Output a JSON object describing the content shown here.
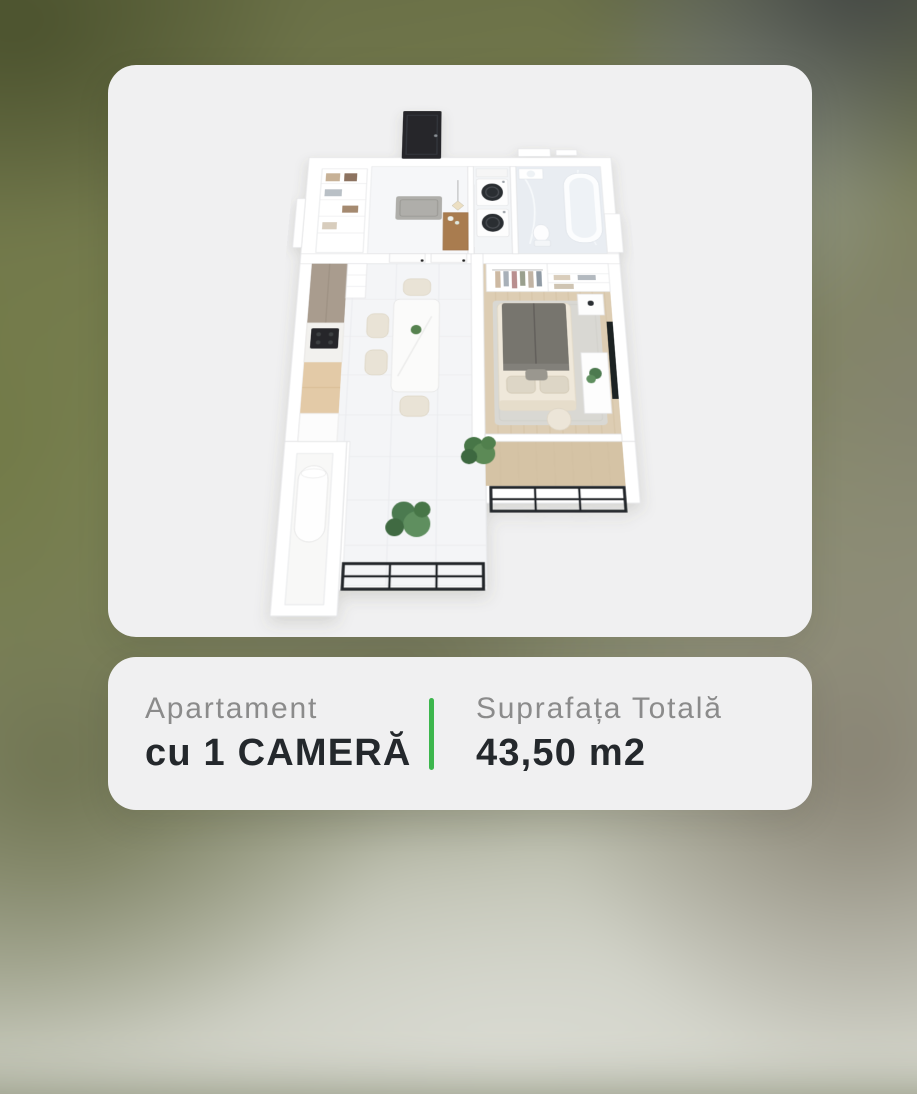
{
  "info_card": {
    "type": {
      "label": "Apartament",
      "value": "cu 1 CAMERĂ"
    },
    "area": {
      "label": "Suprafața Totală",
      "value": "43,50 m2"
    }
  },
  "plan_card": {
    "image": "isometric-3d-floor-plan-one-room-apartment",
    "features": [
      "entry-hall",
      "laundry",
      "bathroom",
      "kitchen",
      "living-dining",
      "bedroom",
      "balcony",
      "boiler-balcony"
    ]
  },
  "colors": {
    "accent_green": "#3CB64D",
    "card_background": "#F0F0F1",
    "label_gray": "#8B8B8B",
    "value_dark": "#24282C"
  }
}
